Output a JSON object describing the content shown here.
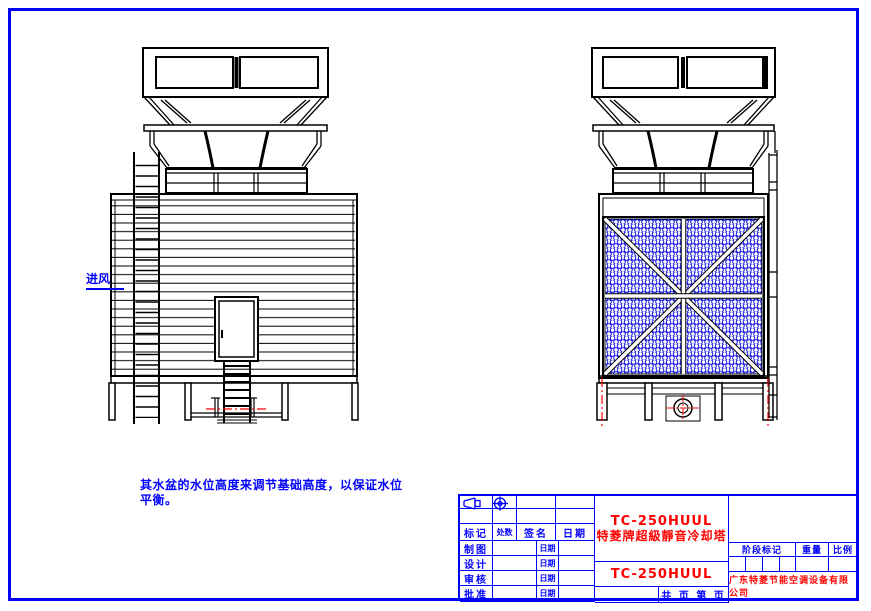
{
  "colors": {
    "sheet_frame_blue": "#0000ff",
    "drawing_line_black": "#000000",
    "centerline_red": "#ff0000",
    "mesh_blue": "#0000dd"
  },
  "annotations": {
    "air_inlet_label": "进风",
    "note_line1": "其水盆的水位高度来调节基础高度，以保证水位",
    "note_line2": "平衡。"
  },
  "title_block": {
    "revision": {
      "headers": [
        "标记",
        "处数",
        "签名",
        "日期"
      ],
      "rows": [
        {
          "label": "制图",
          "date_label": "日期"
        },
        {
          "label": "设计",
          "date_label": "日期"
        },
        {
          "label": "审核",
          "date_label": "日期"
        },
        {
          "label": "批准",
          "date_label": "日期"
        }
      ]
    },
    "product": {
      "model": "TC-250HUUL",
      "name": "特菱牌超級靜音冷却塔",
      "model_repeat": "TC-250HUUL"
    },
    "page_info": "共 页 第 页",
    "stage": {
      "stage_label": "阶段标记",
      "weight_label": "重量",
      "scale_label": "比例"
    },
    "company": "广东特菱节能空调设备有限公司"
  }
}
